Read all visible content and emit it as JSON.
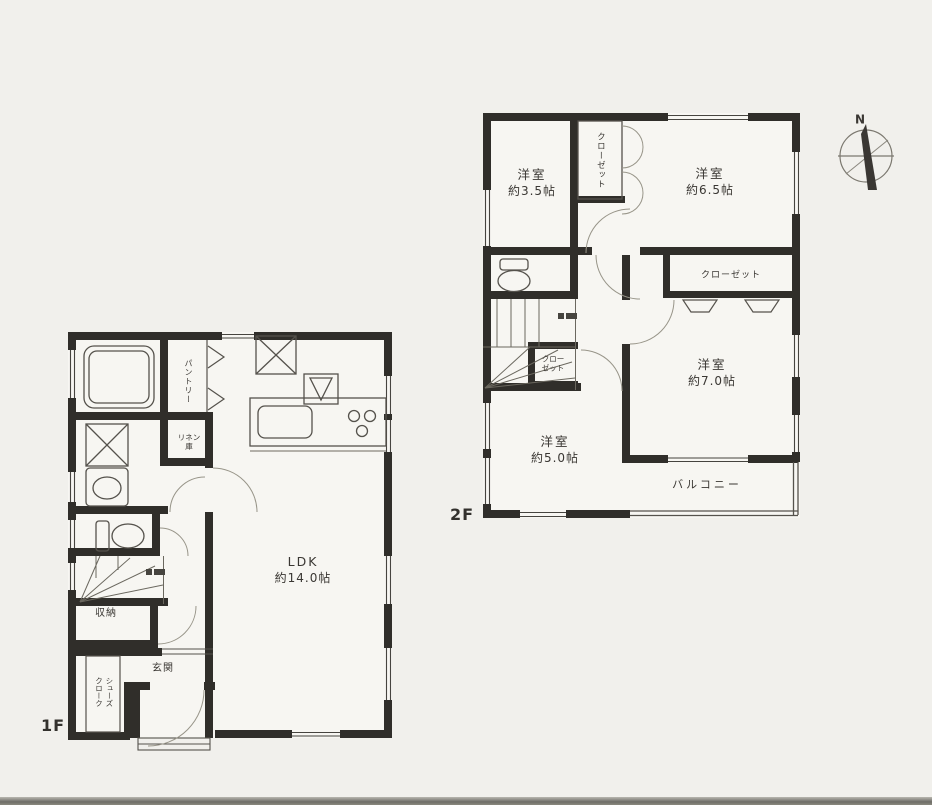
{
  "colors": {
    "paper": "#f1f0ec",
    "ink": "#3a3733",
    "wall": "#302e2a"
  },
  "compass": {
    "north_label": "N"
  },
  "floor2": {
    "floor_label": "2F",
    "bedroom_top_left": {
      "name": "洋室",
      "size": "約3.5帖"
    },
    "bedroom_top_right": {
      "name": "洋室",
      "size": "約6.5帖"
    },
    "bedroom_right": {
      "name": "洋室",
      "size": "約7.0帖"
    },
    "bedroom_bottom_left": {
      "name": "洋室",
      "size": "約5.0帖"
    },
    "closet_vertical": {
      "name": "クローゼット"
    },
    "closet_wide": {
      "name": "クローゼット"
    },
    "closet_small": {
      "line1": "クロー",
      "line2": "ゼット"
    },
    "balcony": {
      "name": "バルコニー"
    }
  },
  "floor1": {
    "floor_label": "1F",
    "ldk": {
      "name": "LDK",
      "size": "約14.0帖"
    },
    "entrance": {
      "name": "玄関"
    },
    "storage": {
      "name": "収納"
    },
    "pantry": {
      "name": "パントリー"
    },
    "linen_closet": {
      "name": "リネン庫"
    },
    "shoe_closet": {
      "line1": "シューズ",
      "line2": "クローク"
    }
  }
}
